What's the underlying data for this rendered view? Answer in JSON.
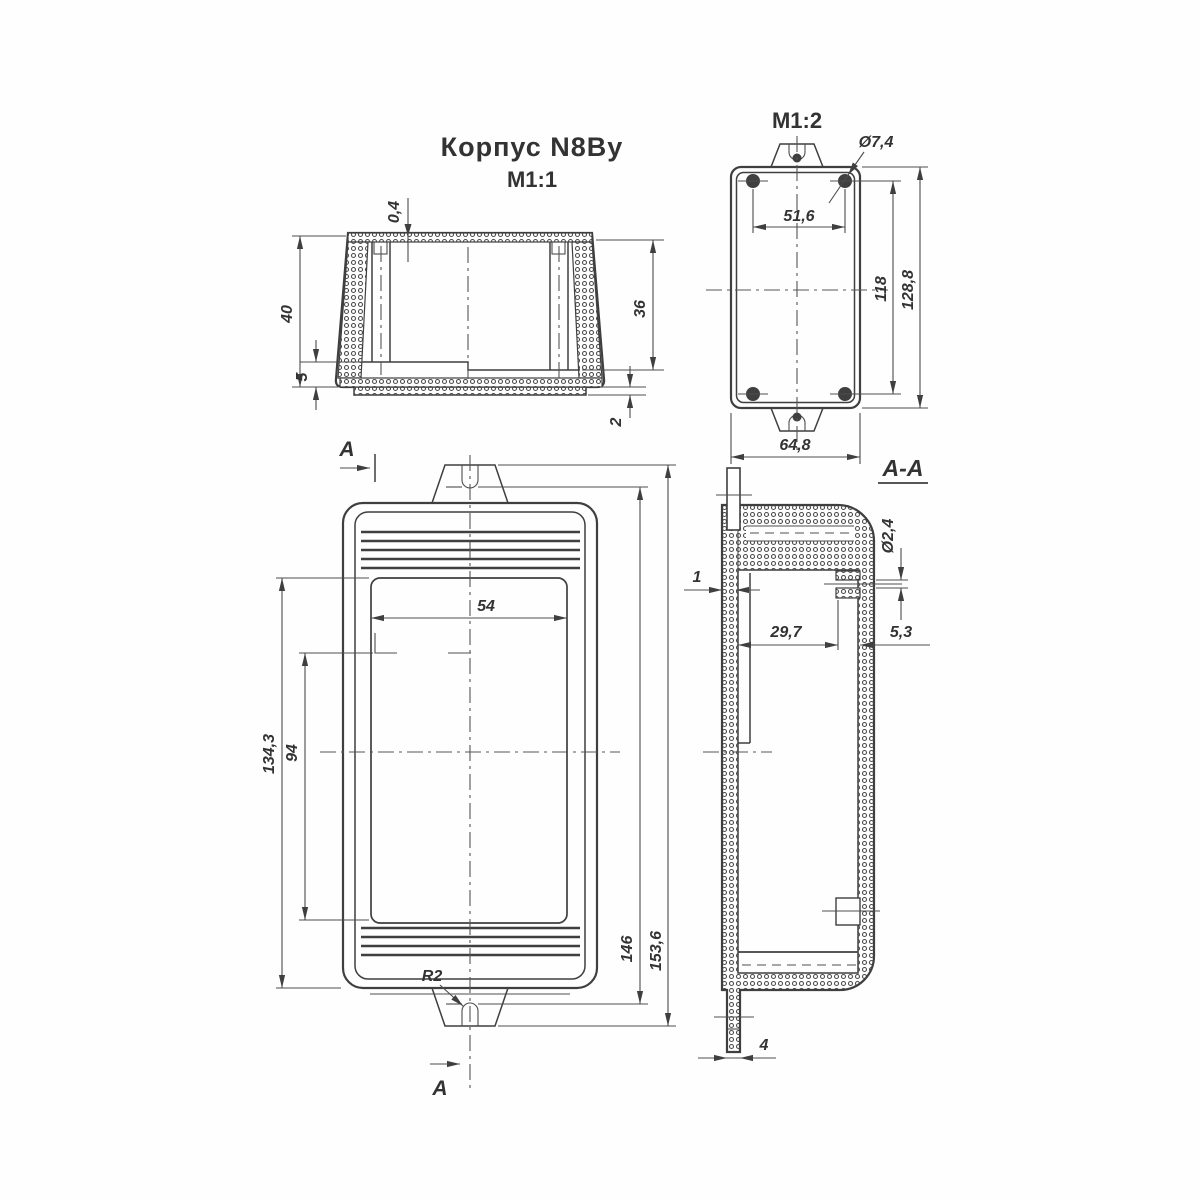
{
  "title": {
    "name": "Корпус N8By",
    "scale": "М1:1"
  },
  "side_view": {
    "dims": {
      "rib": "0,4",
      "height": "40",
      "shelf": "5",
      "depth": "36",
      "lip": "2"
    }
  },
  "back_view": {
    "scale": "М1:2",
    "dims": {
      "hole_diameter": "Ø7,4",
      "holes_span_width": "51,6",
      "holes_span_height": "118",
      "height": "128,8",
      "width": "64,8"
    }
  },
  "front_view": {
    "cut_letter": "А",
    "dims": {
      "panel_width": "54",
      "inner_height": "134,3",
      "panel_height": "94",
      "body_height": "146",
      "overall_height": "153,6",
      "notch_radius": "R2"
    }
  },
  "section_view": {
    "label": "А-А",
    "dims": {
      "wall_thickness": "1",
      "hole_diameter": "Ø2,4",
      "boss_offset": "29,7",
      "boss_width": "5,3",
      "tab_thickness": "4"
    }
  },
  "colors": {
    "line": "#3f3f3f",
    "dim_line": "#4d4d4d",
    "background": "#ffffff"
  }
}
